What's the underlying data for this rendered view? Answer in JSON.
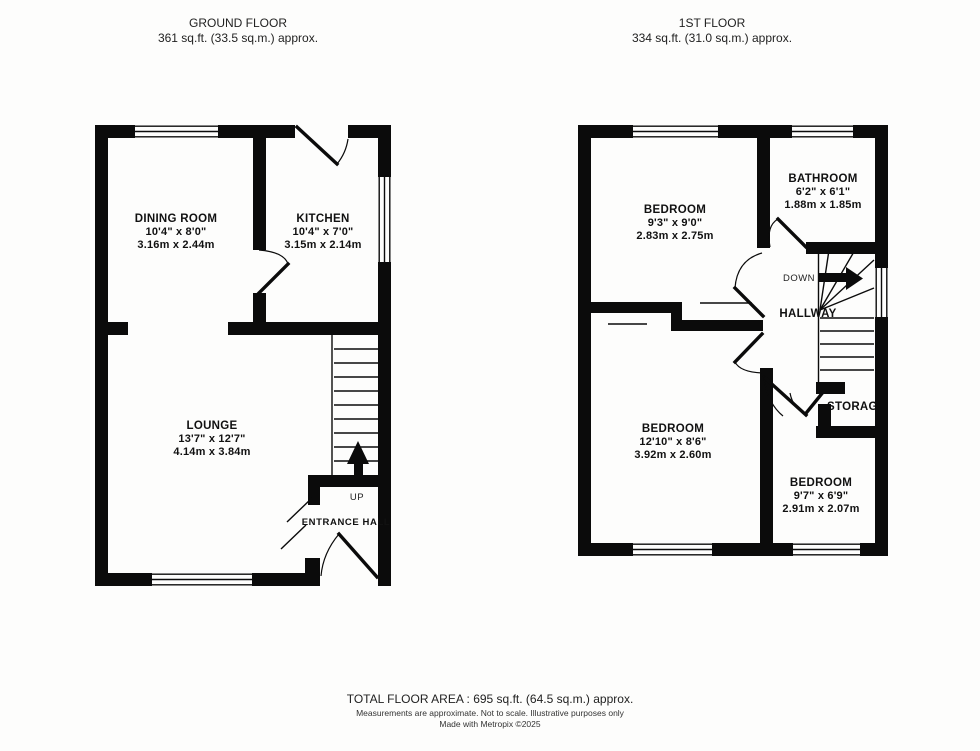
{
  "ground_floor": {
    "title": "GROUND FLOOR",
    "area": "361 sq.ft. (33.5 sq.m.) approx.",
    "rooms": {
      "dining": {
        "name": "DINING ROOM",
        "imperial": "10'4\" x 8'0\"",
        "metric": "3.16m x 2.44m"
      },
      "kitchen": {
        "name": "KITCHEN",
        "imperial": "10'4\" x 7'0\"",
        "metric": "3.15m x 2.14m"
      },
      "lounge": {
        "name": "LOUNGE",
        "imperial": "13'7\" x 12'7\"",
        "metric": "4.14m x 3.84m"
      },
      "entrance_hall": {
        "name": "ENTRANCE HALL"
      }
    },
    "stairs_label": "UP"
  },
  "first_floor": {
    "title": "1ST FLOOR",
    "area": "334 sq.ft. (31.0 sq.m.) approx.",
    "rooms": {
      "bedroom_front": {
        "name": "BEDROOM",
        "imperial": "9'3\" x 9'0\"",
        "metric": "2.83m x 2.75m"
      },
      "bathroom": {
        "name": "BATHROOM",
        "imperial": "6'2\" x 6'1\"",
        "metric": "1.88m x 1.85m"
      },
      "bedroom_rear": {
        "name": "BEDROOM",
        "imperial": "12'10\" x 8'6\"",
        "metric": "3.92m x 2.60m"
      },
      "bedroom_small": {
        "name": "BEDROOM",
        "imperial": "9'7\" x 6'9\"",
        "metric": "2.91m x 2.07m"
      },
      "hallway": {
        "name": "HALLWAY"
      },
      "storage": {
        "name": "STORAGE"
      }
    },
    "stairs_label": "DOWN"
  },
  "footer": {
    "total_area": "TOTAL FLOOR AREA : 695 sq.ft. (64.5 sq.m.) approx.",
    "disclaimer": "Measurements are approximate.  Not to scale.  Illustrative purposes only",
    "credit": "Made with Metropix ©2025"
  },
  "colors": {
    "wall": "#0b0b0b",
    "background": "#fdfdfc",
    "text": "#1c1c1c"
  }
}
